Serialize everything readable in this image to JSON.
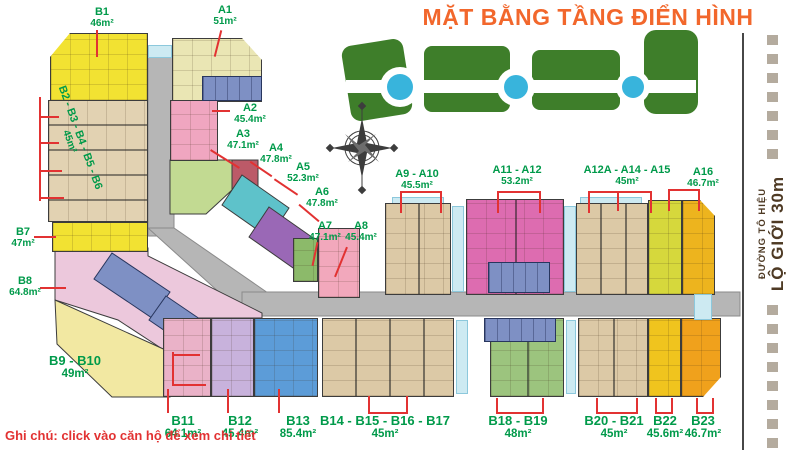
{
  "title": "MẶT BẰNG TẦNG ĐIỂN HÌNH",
  "note": "Ghi chú: click vào căn hộ để xem chi tiết",
  "road": {
    "street": "ĐƯỜNG TÔ HIỆU",
    "boundary": "LỘ GIỚI 30m"
  },
  "colors": {
    "title_orange": "#f2672c",
    "label_green": "#009a4a",
    "callout_red": "#e23232",
    "corridor_gray": "#b6b6b6",
    "core_blue": "#7e90c4",
    "water_blue": "#38b4dc",
    "hedge_green": "#3e7e2a",
    "road_text_brown": "#4e3a24"
  },
  "units": {
    "b1": {
      "label": "B1",
      "area": "46m²",
      "color": "#f2e232"
    },
    "a1": {
      "label": "A1",
      "area": "51m²",
      "color": "#eae6b4"
    },
    "a2": {
      "label": "A2",
      "area": "45.4m²",
      "color": "#f0a6c0"
    },
    "a3": {
      "label": "A3",
      "area": "47.1m²",
      "color": "#c2da92"
    },
    "a4": {
      "label": "A4",
      "area": "47.8m²",
      "color": "#bc5a68"
    },
    "a5": {
      "label": "A5",
      "area": "52.3m²",
      "color": "#5ec2ca"
    },
    "a6": {
      "label": "A6",
      "area": "47.8m²",
      "color": "#9a68b6"
    },
    "a7": {
      "label": "A7",
      "area": "47.1m²",
      "color": "#8cba6a"
    },
    "a8": {
      "label": "A8",
      "area": "45.4m²",
      "color": "#f2a8bc"
    },
    "a9a10": {
      "label": "A9 - A10",
      "area": "45.5m²",
      "color": "#dcc9a6"
    },
    "a11a12": {
      "label": "A11 - A12",
      "area": "53.2m²",
      "color": "#dd6cb0"
    },
    "a12a1415": {
      "label": "A12A - A14 - A15",
      "area": "45m²",
      "color": "#dcc9a6"
    },
    "a16": {
      "label": "A16",
      "area": "46.7m²",
      "color": "#edb41e"
    },
    "b2b6": {
      "label": "B2 - B3 - B4 - B5 - B6",
      "area": "45m²",
      "color": "#e2d2b2"
    },
    "b7": {
      "label": "B7",
      "area": "47m²",
      "color": "#f2e232"
    },
    "b8": {
      "label": "B8",
      "area": "64.8m²",
      "color": "#ecc8dc"
    },
    "b9b10": {
      "label": "B9 - B10",
      "area": "49m²",
      "color": "#f2e8a2"
    },
    "b11": {
      "label": "B11",
      "area": "64.1m²",
      "color": "#eab2c8"
    },
    "b12": {
      "label": "B12",
      "area": "45.4m²",
      "color": "#c8b2dc"
    },
    "b13": {
      "label": "B13",
      "area": "85.4m²",
      "color": "#5c9cd8"
    },
    "b14b17": {
      "label": "B14 - B15 - B16 - B17",
      "area": "45m²",
      "color": "#dcc9a6"
    },
    "b18b19": {
      "label": "B18 - B19",
      "area": "48m²",
      "color": "#9cc47e"
    },
    "b20b21": {
      "label": "B20 - B21",
      "area": "45m²",
      "color": "#dcc9a6"
    },
    "b22": {
      "label": "B22",
      "area": "45.6m²",
      "color": "#f0c41e"
    },
    "b23": {
      "label": "B23",
      "area": "46.7m²",
      "color": "#f0a11c"
    }
  }
}
